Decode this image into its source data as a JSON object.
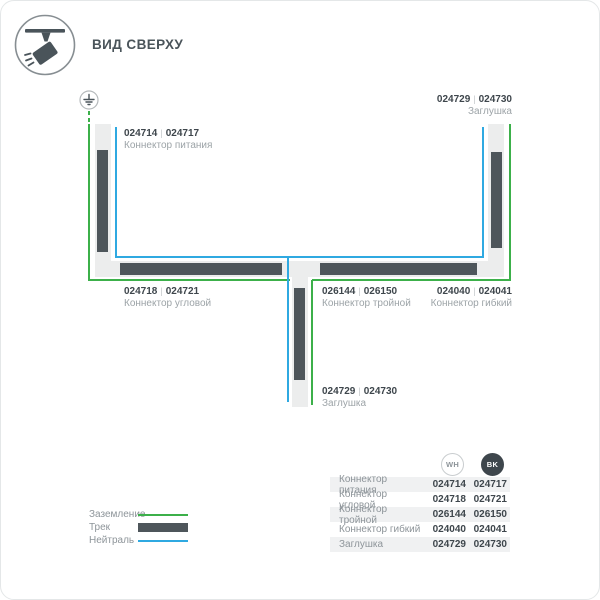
{
  "header": {
    "title": "ВИД СВЕРХУ"
  },
  "colors": {
    "ground_green": "#3cb04a",
    "neutral_blue": "#2fa9e1",
    "track_dark": "#4e565b",
    "track_light": "#eceded",
    "text_dark": "#3e464c",
    "text_gray": "#9ca3a7"
  },
  "diagram": {
    "separator": "|",
    "labels": [
      {
        "code_wh": "024714",
        "code_bk": "024717",
        "name": "Коннектор питания"
      },
      {
        "code_wh": "024729",
        "code_bk": "024730",
        "name": "Заглушка"
      },
      {
        "code_wh": "024718",
        "code_bk": "024721",
        "name": "Коннектор угловой"
      },
      {
        "code_wh": "026144",
        "code_bk": "026150",
        "name": "Коннектор тройной"
      },
      {
        "code_wh": "024040",
        "code_bk": "024041",
        "name": "Коннектор гибкий"
      },
      {
        "code_wh": "024729",
        "code_bk": "024730",
        "name": "Заглушка"
      }
    ]
  },
  "legend": [
    {
      "label": "Заземление"
    },
    {
      "label": "Трек"
    },
    {
      "label": "Нейтраль"
    }
  ],
  "table": {
    "columns": [
      {
        "label": "WH"
      },
      {
        "label": "BK"
      }
    ],
    "rows": [
      {
        "name": "Коннектор питания",
        "wh": "024714",
        "bk": "024717"
      },
      {
        "name": "Коннектор угловой",
        "wh": "024718",
        "bk": "024721"
      },
      {
        "name": "Коннектор тройной",
        "wh": "026144",
        "bk": "026150"
      },
      {
        "name": "Коннектор гибкий",
        "wh": "024040",
        "bk": "024041"
      },
      {
        "name": "Заглушка",
        "wh": "024729",
        "bk": "024730"
      }
    ]
  }
}
